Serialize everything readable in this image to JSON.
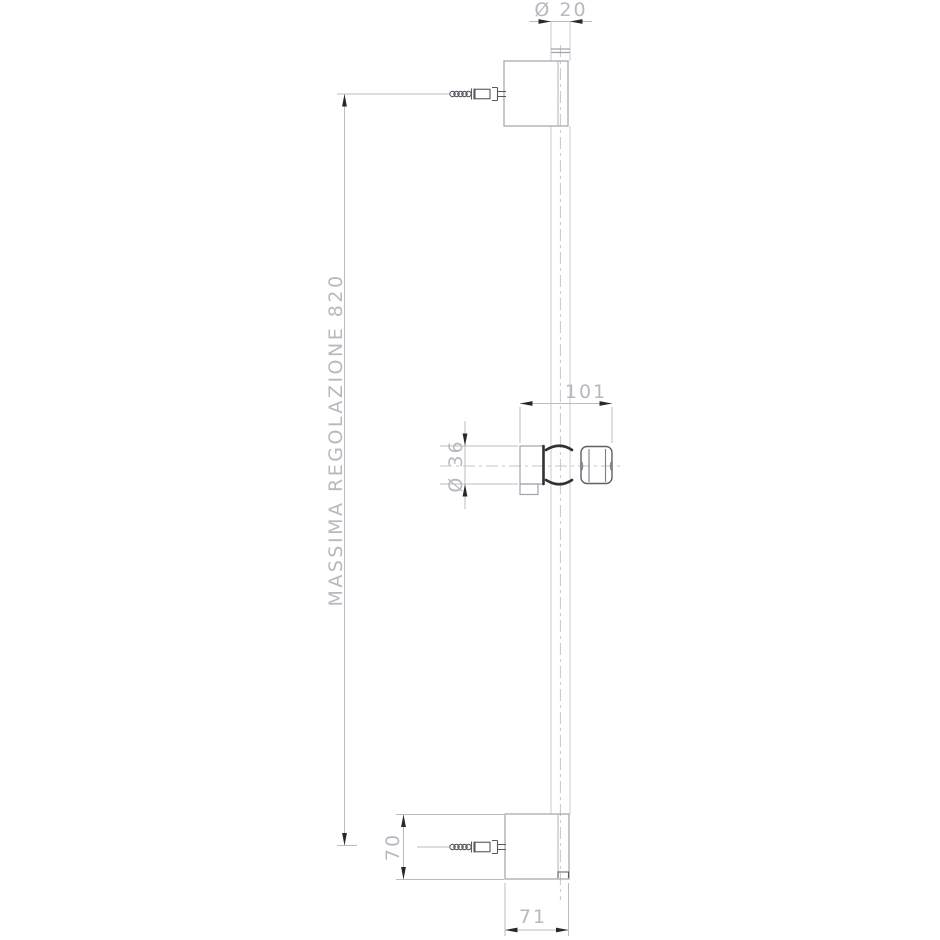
{
  "drawing": {
    "labels": {
      "top_diameter": "Ø 20",
      "max_adjustment": "MASSIMA REGOLAZIONE 820",
      "slider_width": "101",
      "holder_diameter": "Ø 36",
      "bracket_height": "70",
      "bracket_width": "71"
    },
    "colors": {
      "background": "#ffffff",
      "outline": "#9fa3ab",
      "thin_line": "#b9bcc2",
      "dim_text": "#b6b9bf",
      "heavy_line": "#2f3236",
      "arrow": "#26282c"
    }
  }
}
